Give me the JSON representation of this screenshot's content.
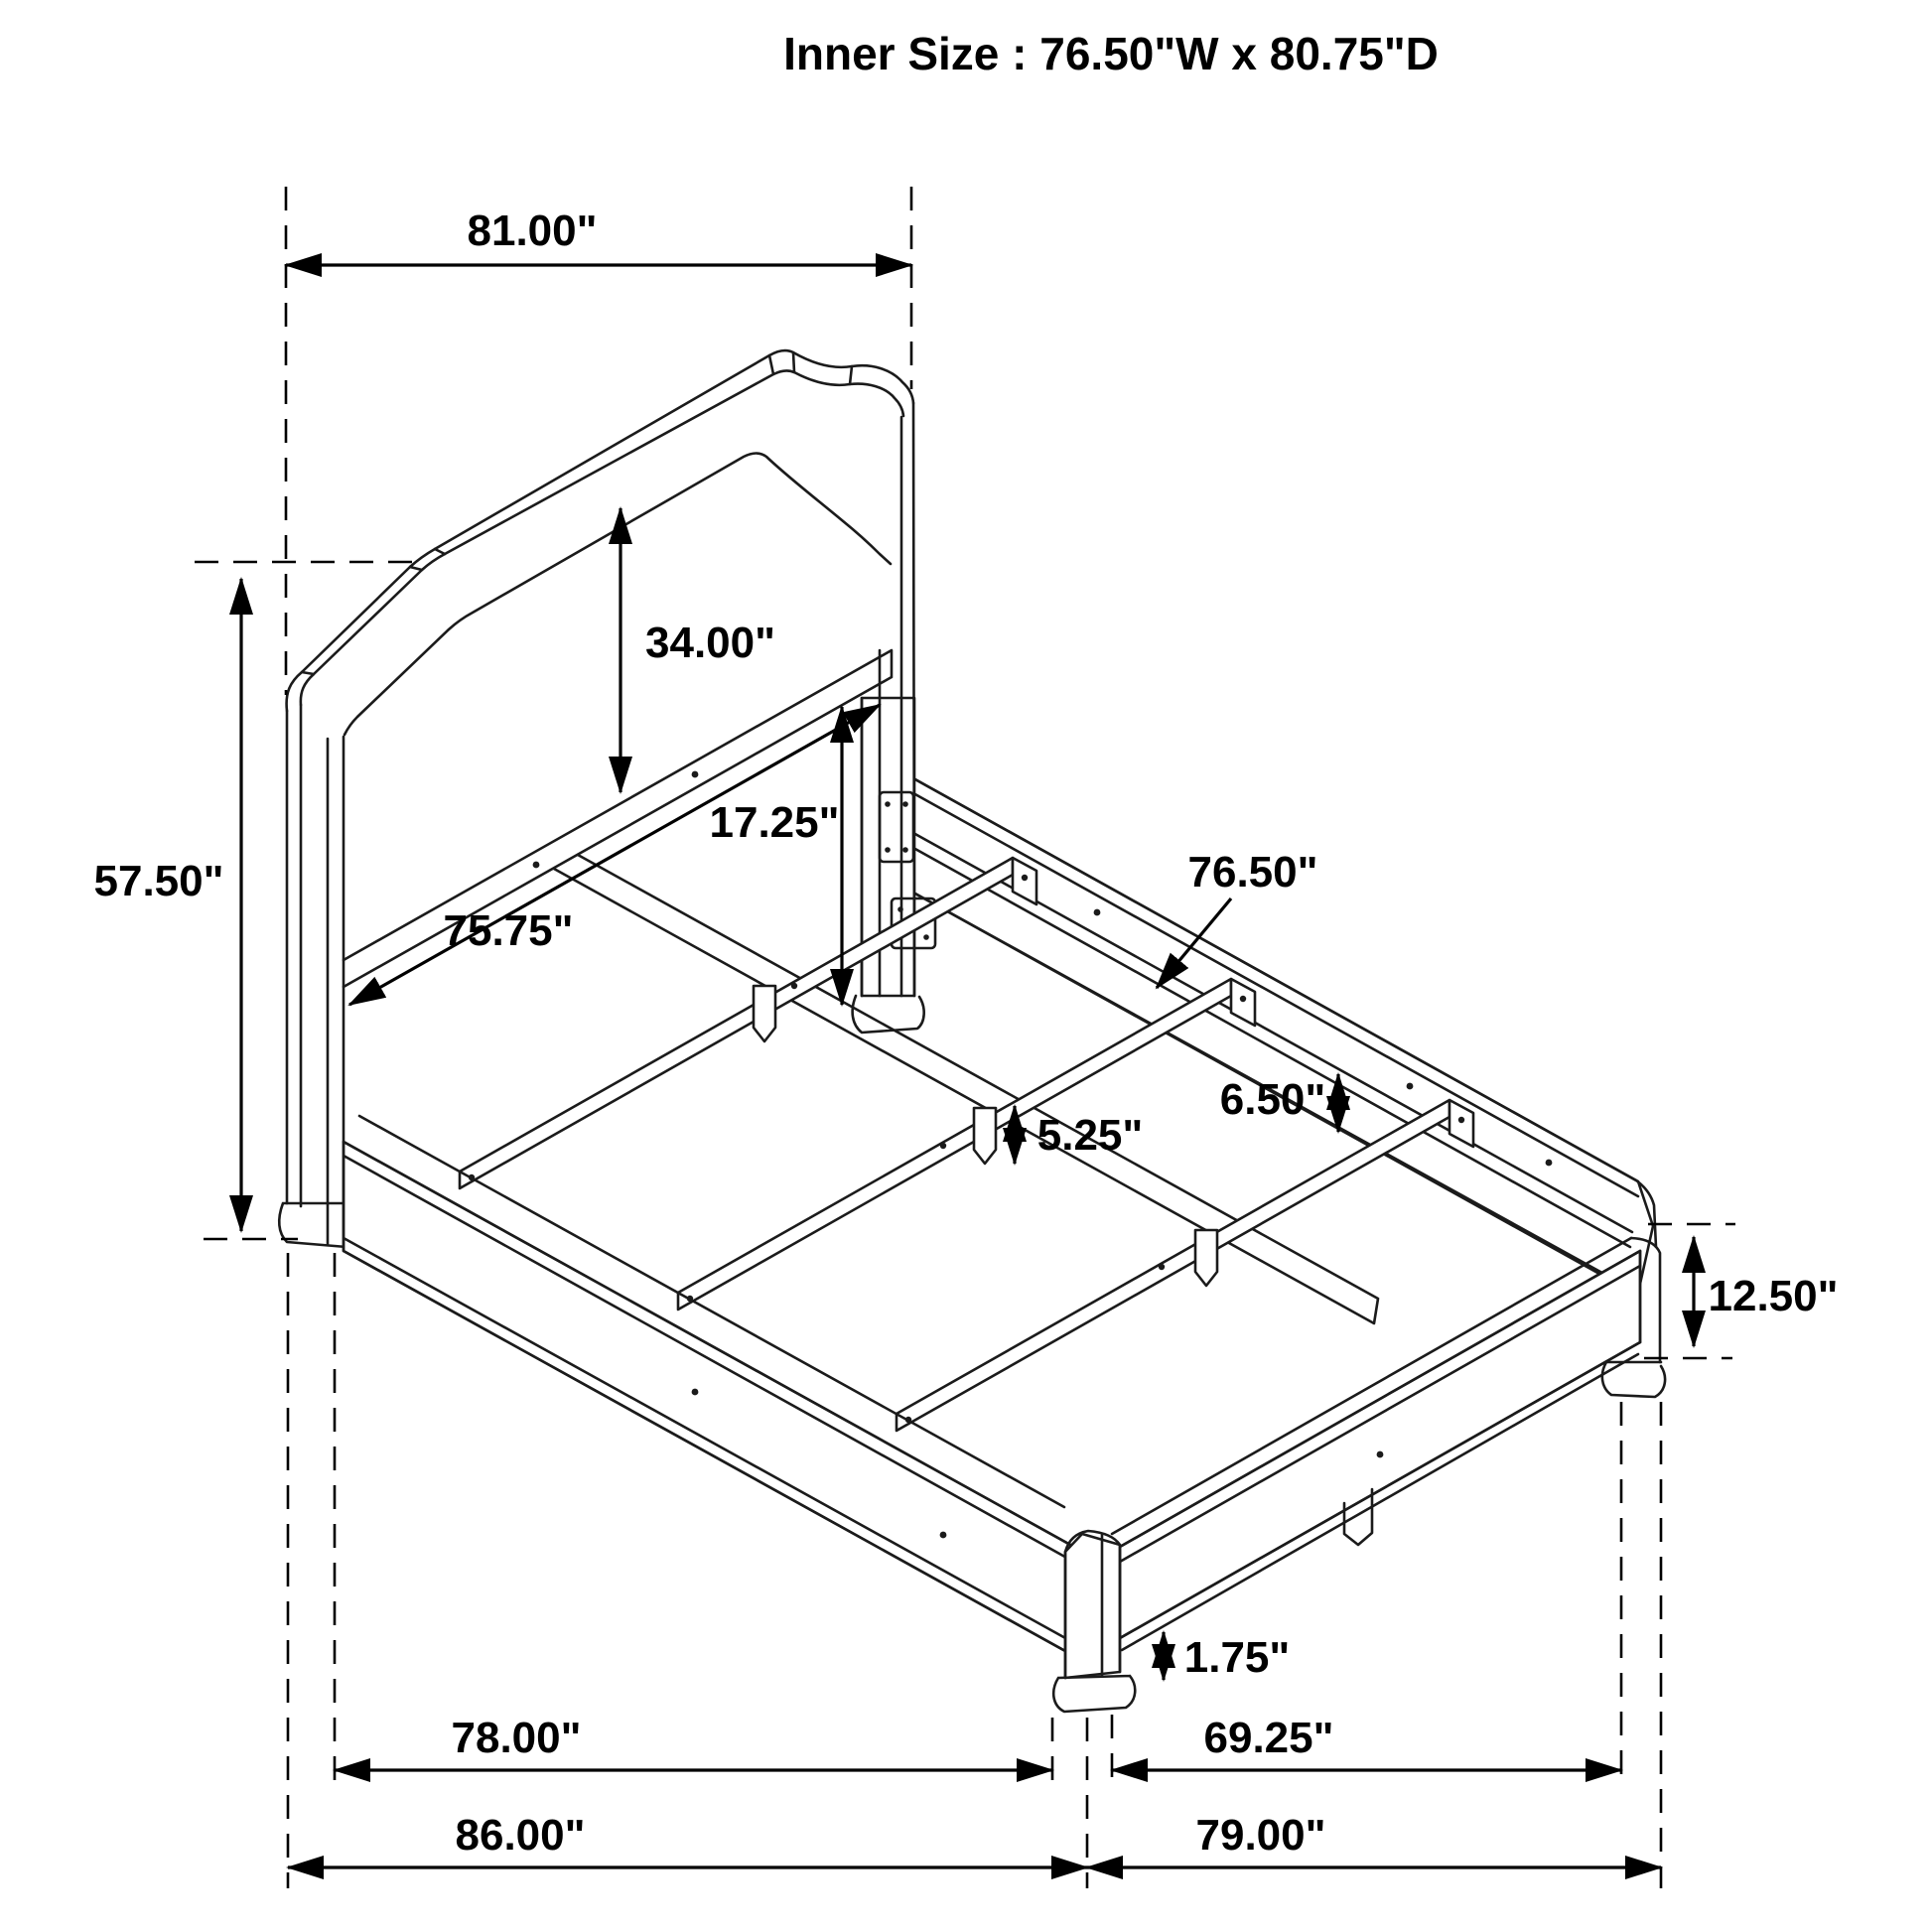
{
  "title": "Inner Size : 76.50\"W x 80.75\"D",
  "colors": {
    "line": "#1b1b1b",
    "background": "#ffffff"
  },
  "dimensions": {
    "headboard_width": {
      "label": "81.00\""
    },
    "headboard_height": {
      "label": "57.50\""
    },
    "panel_height": {
      "label": "34.00\""
    },
    "panel_to_slat": {
      "label": "17.25\""
    },
    "headboard_inner_width": {
      "label": "75.75\""
    },
    "slat_length": {
      "label": "76.50\""
    },
    "rail_height": {
      "label": "6.50\""
    },
    "slat_leg_height": {
      "label": "5.25\""
    },
    "footboard_height": {
      "label": "12.50\""
    },
    "foot_height": {
      "label": "1.75\""
    },
    "rail_length": {
      "label": "78.00\""
    },
    "footboard_inner_width": {
      "label": "69.25\""
    },
    "overall_length": {
      "label": "86.00\""
    },
    "footboard_width": {
      "label": "79.00\""
    }
  }
}
